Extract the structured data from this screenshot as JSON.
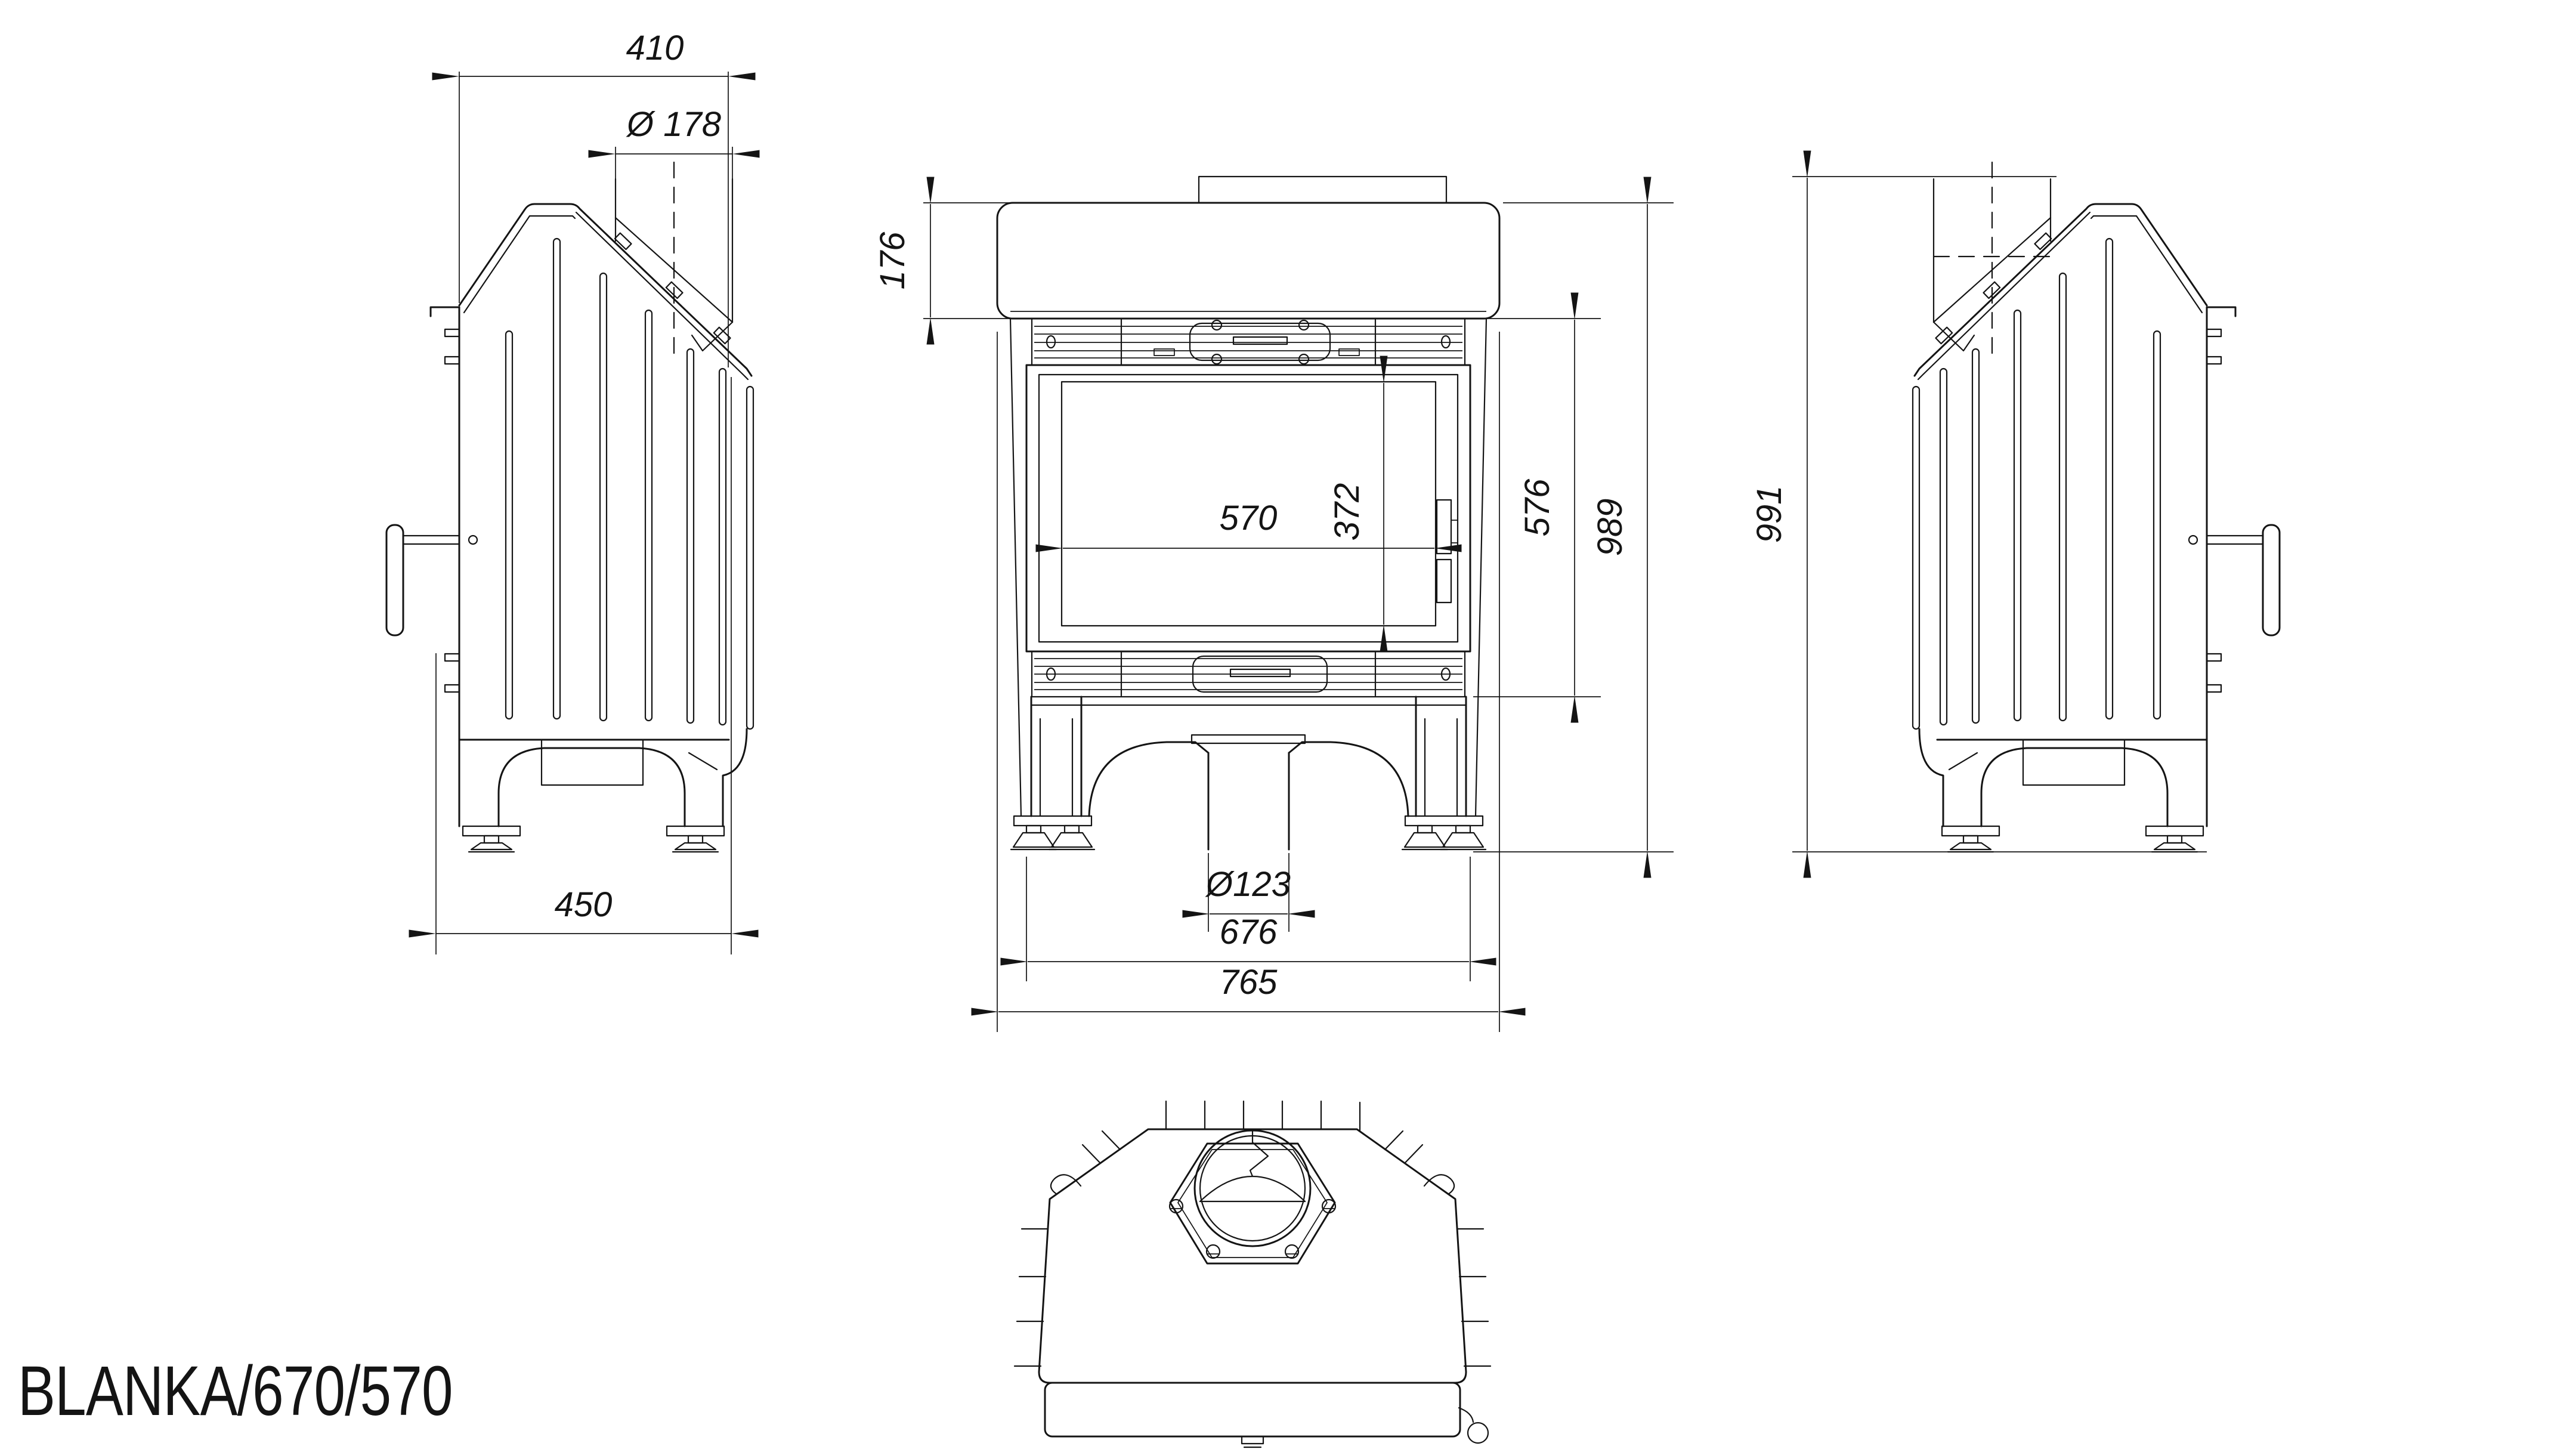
{
  "page": {
    "background": "#ffffff",
    "line_color": "#141414"
  },
  "title": {
    "text": "BLANKA/670/570"
  },
  "views": {
    "left_side": {
      "label": "left side view",
      "dim_top_depth": "410",
      "dim_flue_diameter": "Ø 178",
      "dim_base_depth": "450"
    },
    "front": {
      "label": "front view",
      "dim_hood_height": "176",
      "dim_glass_height": "372",
      "dim_glass_width": "570",
      "dim_firebox_height": "576",
      "dim_total_height": "989",
      "dim_air_inlet_diameter": "Ø123",
      "dim_body_width": "676",
      "dim_total_width": "765"
    },
    "right_side": {
      "label": "right side view",
      "dim_overall_height": "991"
    },
    "top": {
      "label": "top view"
    }
  }
}
